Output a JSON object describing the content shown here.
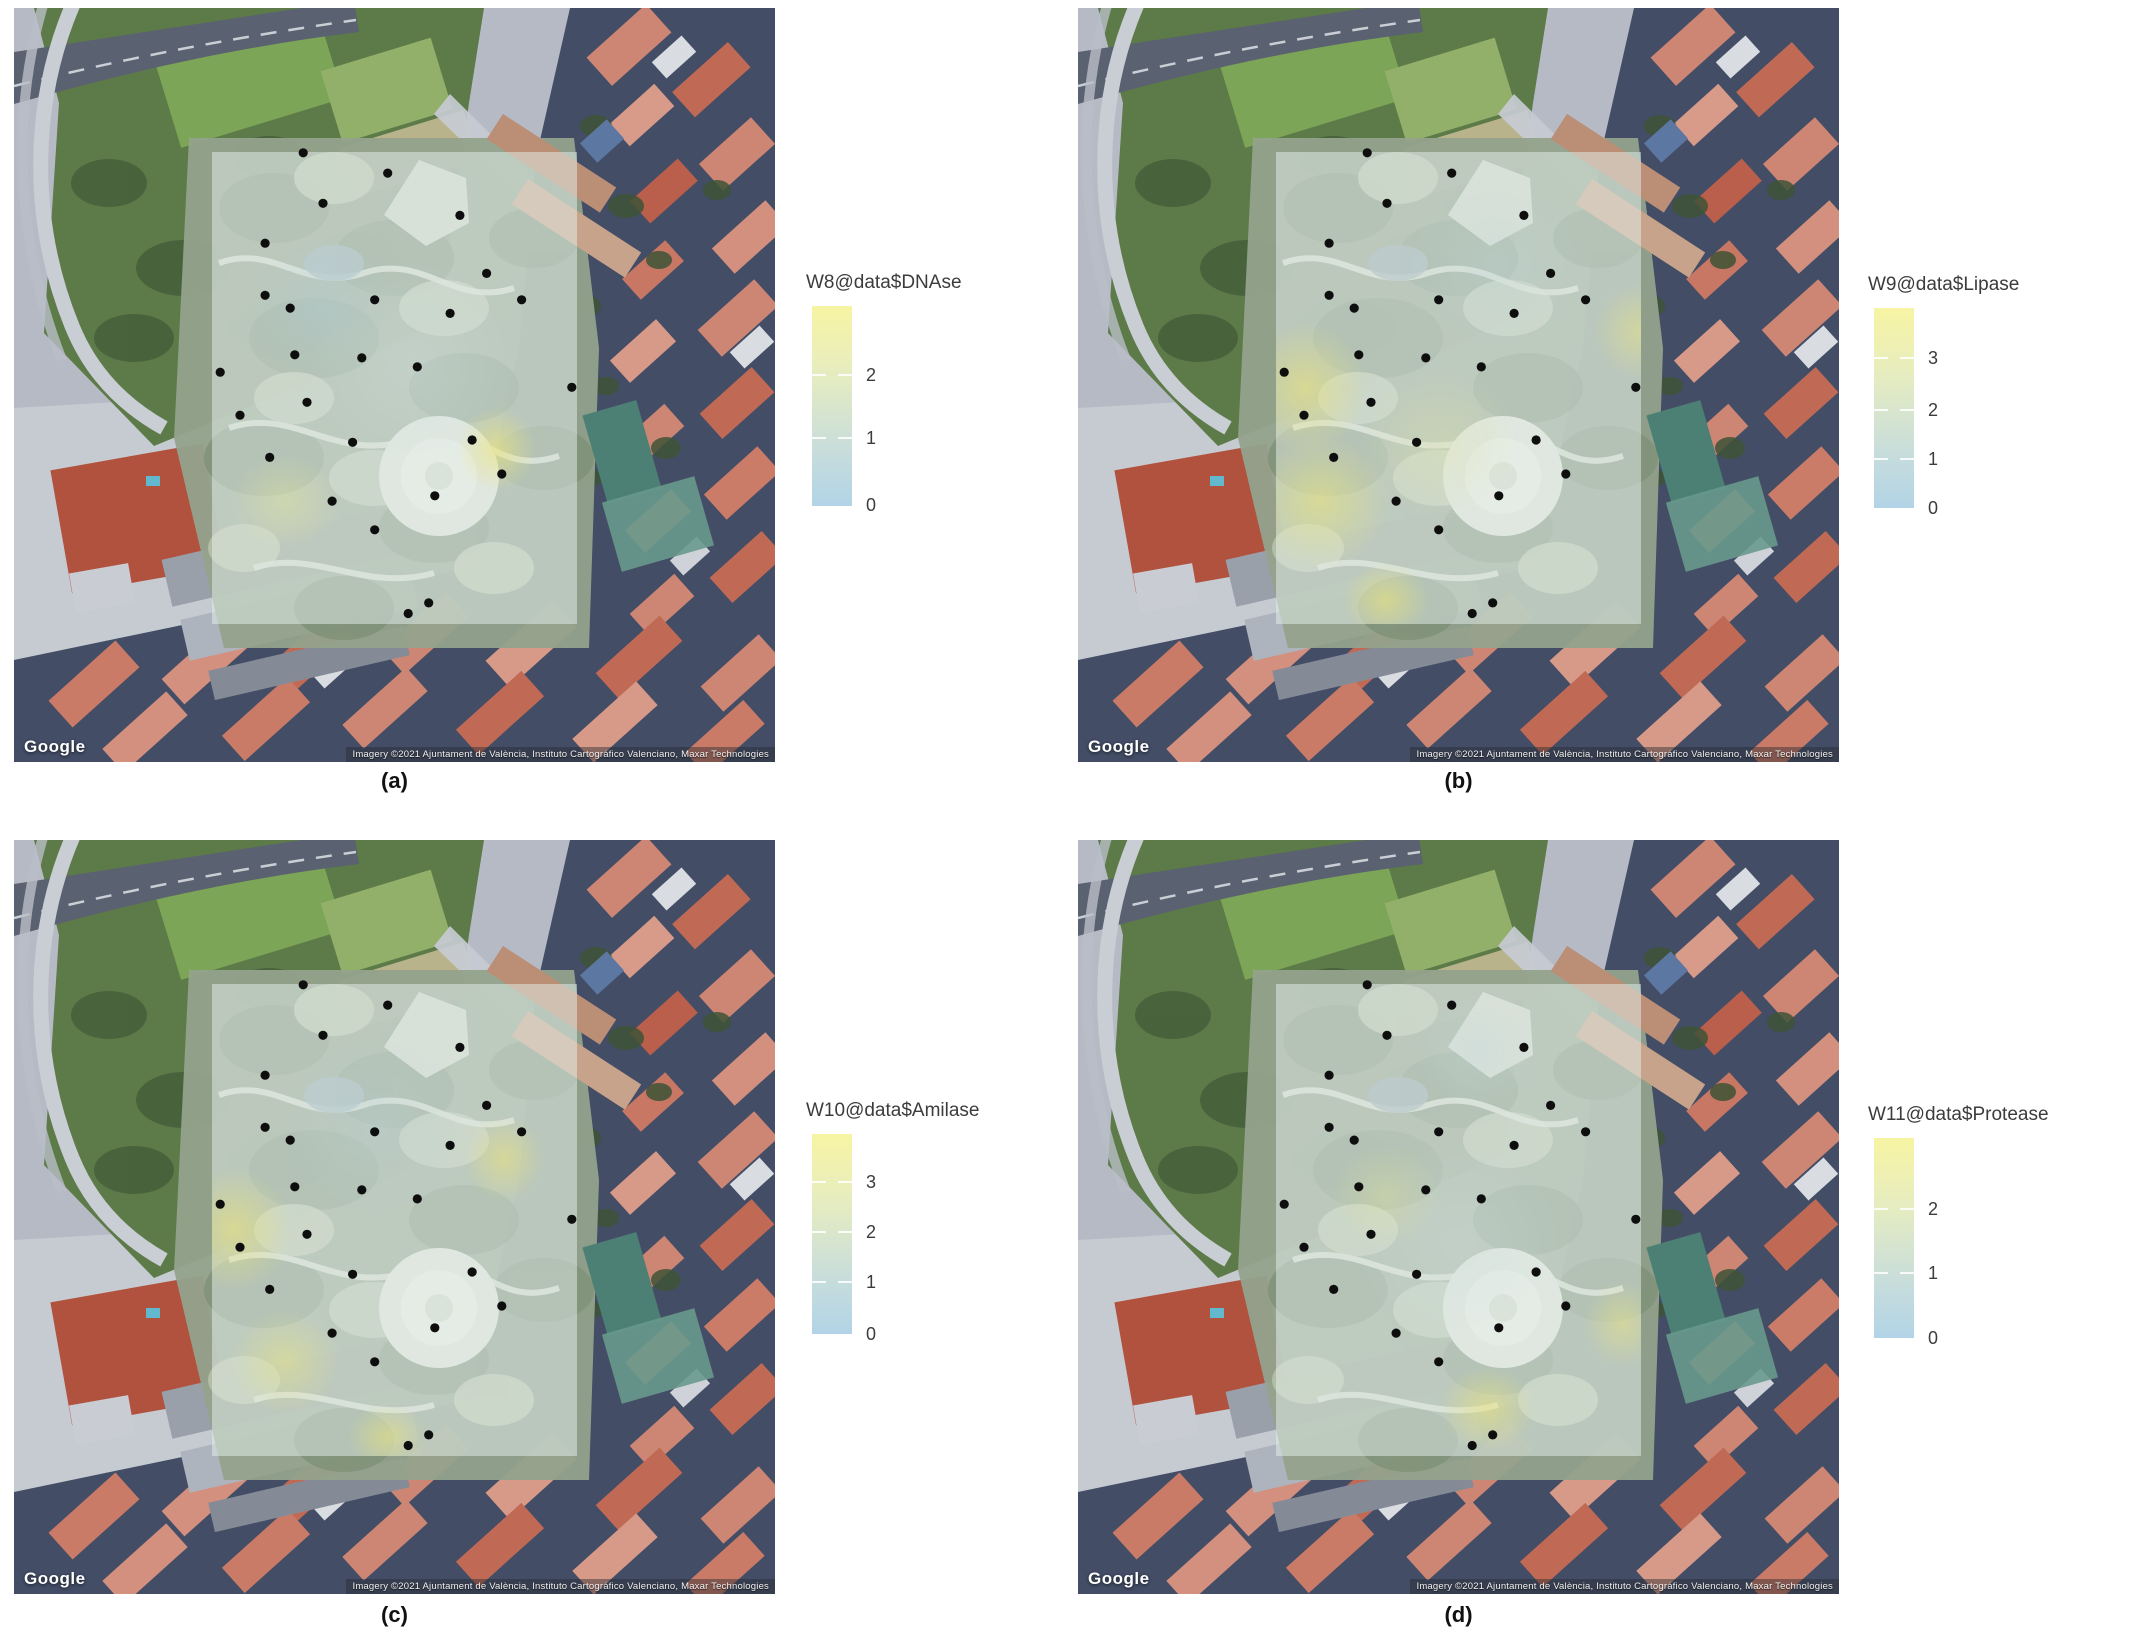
{
  "figure": {
    "google_label": "Google",
    "attribution": "Imagery ©2021 Ajuntament de València, Instituto Cartográfico Valenciano, Maxar Technologies"
  },
  "colors": {
    "legend_high": "#f7f4a3",
    "legend_mid": "#d3e3d2",
    "legend_low": "#b2d4e6",
    "sample_point": "#0e0e0e",
    "overlay_base": "rgba(226,238,233,0.52)",
    "water_pond": "#4d8075",
    "roof_salmon": "#cd8673",
    "park_green": "#94a28c"
  },
  "panels": [
    {
      "id": "a",
      "label": "(a)",
      "legend_title": "W8@data$DNAse",
      "legend_ticks": [
        {
          "label": "2",
          "frac": 0.345
        },
        {
          "label": "1",
          "frac": 0.66
        },
        {
          "label": "0",
          "frac": 0.995
        }
      ],
      "hotspots": [
        {
          "x": 78,
          "y": 63,
          "rx": 11,
          "ry": 9,
          "c": "rgba(237,230,122,0.62)"
        },
        {
          "x": 20,
          "y": 74,
          "rx": 15,
          "ry": 10,
          "c": "rgba(232,231,150,0.38)"
        },
        {
          "x": 30,
          "y": 33,
          "rx": 20,
          "ry": 15,
          "c": "rgba(175,205,222,0.32)"
        },
        {
          "x": 55,
          "y": 45,
          "rx": 28,
          "ry": 22,
          "c": "rgba(205,222,226,0.30)"
        }
      ]
    },
    {
      "id": "b",
      "label": "(b)",
      "legend_title": "W9@data$Lipase",
      "legend_ticks": [
        {
          "label": "3",
          "frac": 0.25
        },
        {
          "label": "2",
          "frac": 0.51
        },
        {
          "label": "1",
          "frac": 0.755
        },
        {
          "label": "0",
          "frac": 1.0
        }
      ],
      "hotspots": [
        {
          "x": 8,
          "y": 50,
          "rx": 17,
          "ry": 14,
          "c": "rgba(235,228,118,0.58)"
        },
        {
          "x": 12,
          "y": 74,
          "rx": 19,
          "ry": 14,
          "c": "rgba(236,230,120,0.55)"
        },
        {
          "x": 30,
          "y": 95,
          "rx": 12,
          "ry": 8,
          "c": "rgba(235,228,118,0.58)"
        },
        {
          "x": 100,
          "y": 38,
          "rx": 13,
          "ry": 10,
          "c": "rgba(233,228,132,0.5)"
        },
        {
          "x": 45,
          "y": 62,
          "rx": 22,
          "ry": 16,
          "c": "rgba(225,228,162,0.33)"
        },
        {
          "x": 60,
          "y": 24,
          "rx": 24,
          "ry": 17,
          "c": "rgba(190,212,220,0.3)"
        }
      ]
    },
    {
      "id": "c",
      "label": "(c)",
      "legend_title": "W10@data$Amilase",
      "legend_ticks": [
        {
          "label": "3",
          "frac": 0.24
        },
        {
          "label": "2",
          "frac": 0.49
        },
        {
          "label": "1",
          "frac": 0.74
        },
        {
          "label": "0",
          "frac": 1.0
        }
      ],
      "hotspots": [
        {
          "x": 6,
          "y": 52,
          "rx": 16,
          "ry": 13,
          "c": "rgba(235,228,118,0.58)"
        },
        {
          "x": 80,
          "y": 37,
          "rx": 11,
          "ry": 9,
          "c": "rgba(235,228,118,0.52)"
        },
        {
          "x": 20,
          "y": 80,
          "rx": 15,
          "ry": 11,
          "c": "rgba(234,229,128,0.48)"
        },
        {
          "x": 48,
          "y": 96,
          "rx": 11,
          "ry": 7,
          "c": "rgba(235,228,118,0.52)"
        },
        {
          "x": 45,
          "y": 30,
          "rx": 26,
          "ry": 19,
          "c": "rgba(185,208,220,0.3)"
        }
      ]
    },
    {
      "id": "d",
      "label": "(d)",
      "legend_title": "W11@data$Protease",
      "legend_ticks": [
        {
          "label": "2",
          "frac": 0.355
        },
        {
          "label": "1",
          "frac": 0.675
        },
        {
          "label": "0",
          "frac": 1.0
        }
      ],
      "hotspots": [
        {
          "x": 58,
          "y": 90,
          "rx": 13,
          "ry": 9,
          "c": "rgba(235,228,118,0.55)"
        },
        {
          "x": 95,
          "y": 72,
          "rx": 11,
          "ry": 9,
          "c": "rgba(234,229,128,0.48)"
        },
        {
          "x": 30,
          "y": 45,
          "rx": 15,
          "ry": 11,
          "c": "rgba(228,230,148,0.32)"
        },
        {
          "x": 55,
          "y": 14,
          "rx": 17,
          "ry": 12,
          "c": "rgba(195,215,222,0.3)"
        },
        {
          "x": 50,
          "y": 55,
          "rx": 28,
          "ry": 21,
          "c": "rgba(205,222,226,0.28)"
        }
      ]
    }
  ],
  "sample_points_frac": [
    [
      0.38,
      0.192
    ],
    [
      0.491,
      0.219
    ],
    [
      0.406,
      0.259
    ],
    [
      0.586,
      0.275
    ],
    [
      0.33,
      0.312
    ],
    [
      0.621,
      0.352
    ],
    [
      0.33,
      0.381
    ],
    [
      0.474,
      0.387
    ],
    [
      0.667,
      0.387
    ],
    [
      0.363,
      0.398
    ],
    [
      0.573,
      0.405
    ],
    [
      0.369,
      0.46
    ],
    [
      0.457,
      0.464
    ],
    [
      0.53,
      0.476
    ],
    [
      0.271,
      0.483
    ],
    [
      0.733,
      0.503
    ],
    [
      0.385,
      0.523
    ],
    [
      0.297,
      0.54
    ],
    [
      0.445,
      0.576
    ],
    [
      0.602,
      0.573
    ],
    [
      0.336,
      0.596
    ],
    [
      0.418,
      0.654
    ],
    [
      0.553,
      0.647
    ],
    [
      0.641,
      0.618
    ],
    [
      0.474,
      0.692
    ],
    [
      0.545,
      0.789
    ],
    [
      0.518,
      0.803
    ]
  ],
  "chart_data": [
    {
      "type": "heatmap",
      "panel": "(a)",
      "well": "W8",
      "variable": "DNAse",
      "title": "W8@data$DNAse",
      "legend_ticks": [
        2,
        1,
        0
      ],
      "value_range": [
        0,
        3
      ],
      "legend_position": "right",
      "colorscale": {
        "low_color": "#b2d4e6",
        "high_color": "#f7f4a3",
        "low_value": 0
      },
      "n_sample_points": 27,
      "high_zone": "small spot south-east of overlay center"
    },
    {
      "type": "heatmap",
      "panel": "(b)",
      "well": "W9",
      "variable": "Lipase",
      "title": "W9@data$Lipase",
      "legend_ticks": [
        3,
        2,
        1,
        0
      ],
      "value_range": [
        0,
        4
      ],
      "legend_position": "right",
      "colorscale": {
        "low_color": "#b2d4e6",
        "high_color": "#f7f4a3",
        "low_value": 0
      },
      "n_sample_points": 27,
      "high_zone": "west band and south-west corner of overlay"
    },
    {
      "type": "heatmap",
      "panel": "(c)",
      "well": "W10",
      "variable": "Amilase",
      "title": "W10@data$Amilase",
      "legend_ticks": [
        3,
        2,
        1,
        0
      ],
      "value_range": [
        0,
        4
      ],
      "legend_position": "right",
      "colorscale": {
        "low_color": "#b2d4e6",
        "high_color": "#f7f4a3",
        "low_value": 0
      },
      "n_sample_points": 27,
      "high_zone": "west-center edge and mid-east spot of overlay"
    },
    {
      "type": "heatmap",
      "panel": "(d)",
      "well": "W11",
      "variable": "Protease",
      "title": "W11@data$Protease",
      "legend_ticks": [
        2,
        1,
        0
      ],
      "value_range": [
        0,
        3
      ],
      "legend_position": "right",
      "colorscale": {
        "low_color": "#b2d4e6",
        "high_color": "#f7f4a3",
        "low_value": 0
      },
      "n_sample_points": 27,
      "high_zone": "south-center and east edge of overlay"
    }
  ]
}
